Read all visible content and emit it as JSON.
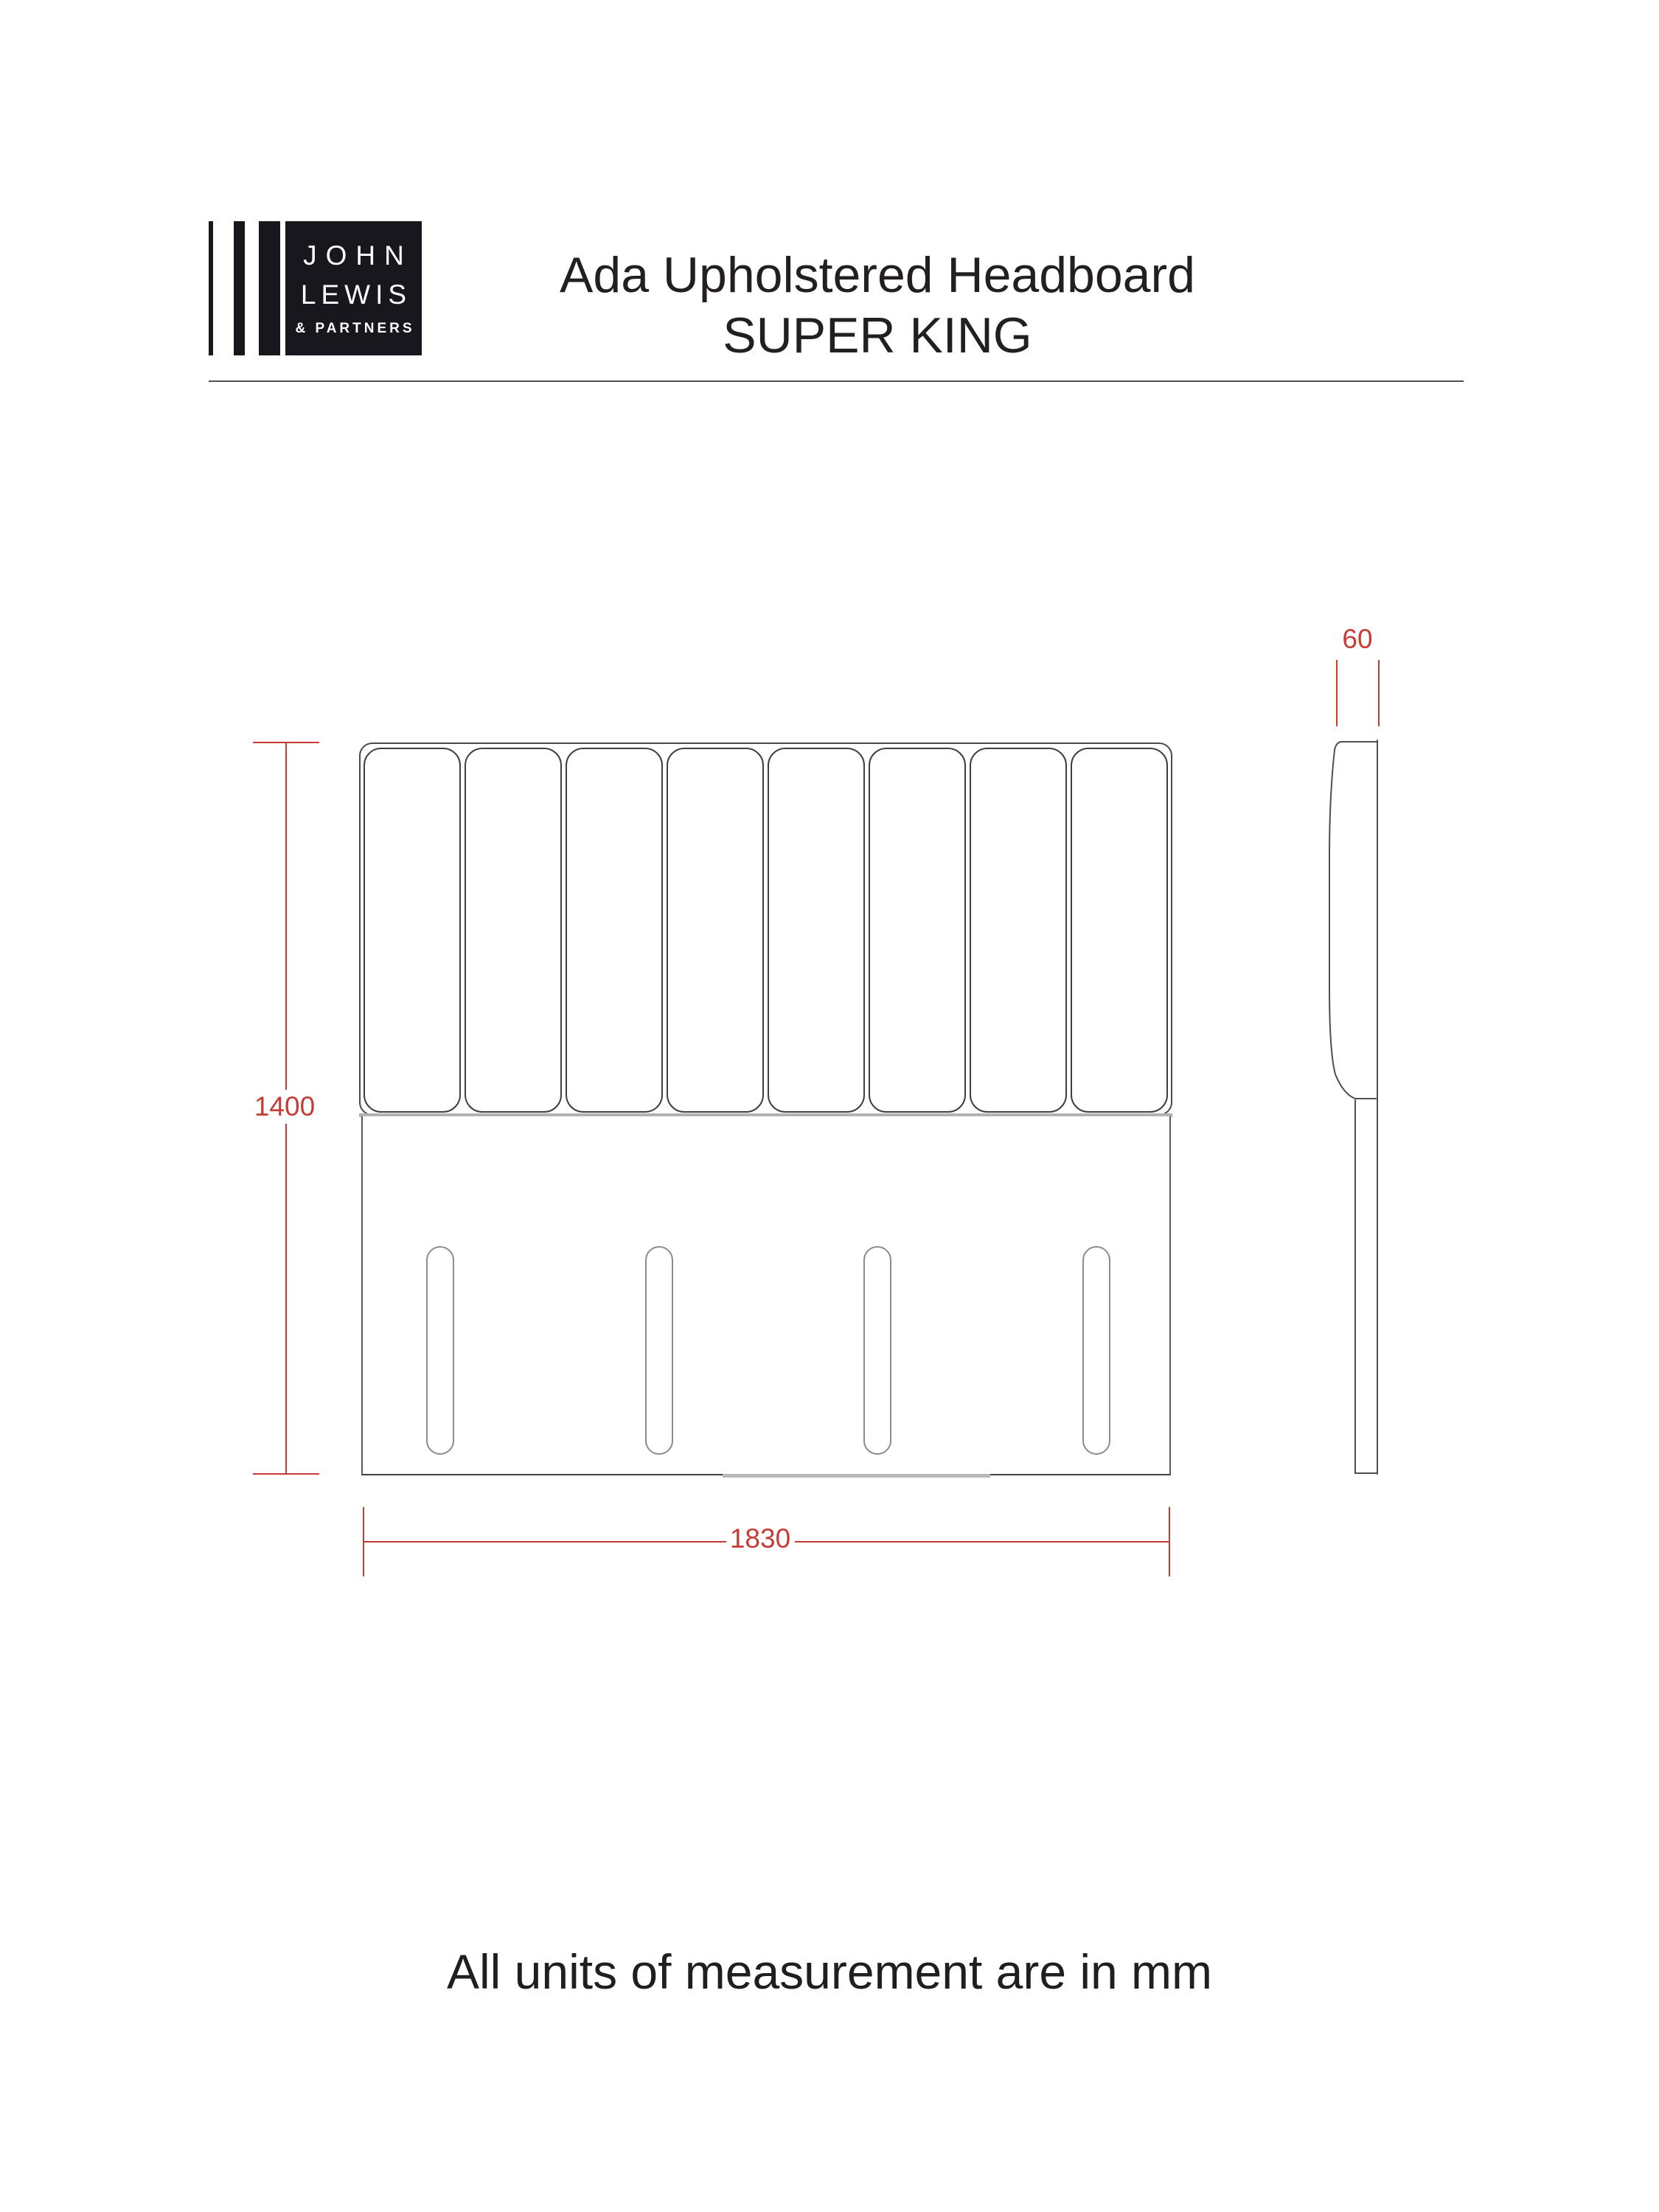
{
  "header": {
    "logo": {
      "brand_line1": "JOHN",
      "brand_line2": "LEWIS",
      "brand_line3": "& PARTNERS"
    },
    "title_line1": "Ada Upholstered Headboard",
    "title_line2": "SUPER KING"
  },
  "diagram": {
    "front_view": {
      "panel_count": 8,
      "slot_count": 4
    },
    "dimensions": {
      "height_mm": "1400",
      "width_mm": "1830",
      "depth_mm": "60"
    }
  },
  "footer": {
    "units_note": "All units of measurement are in mm"
  },
  "colors": {
    "dimension_red": "#c63c34",
    "drawing_line": "#4a4a4a",
    "logo_background": "#17171d"
  }
}
